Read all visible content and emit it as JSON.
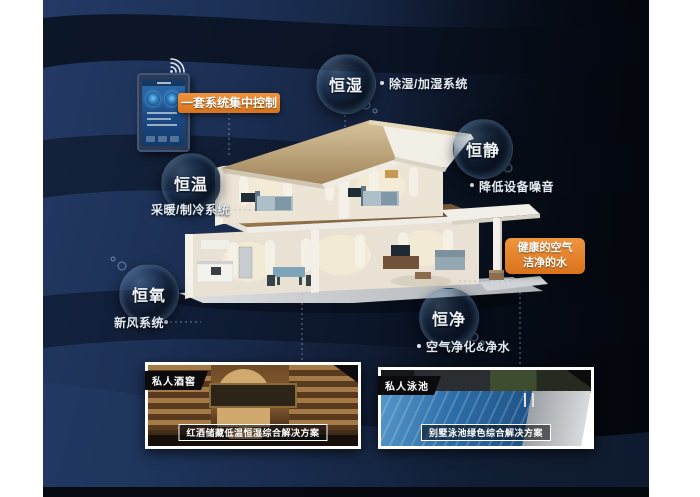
{
  "poster": {
    "accent_orange": "#e0812a",
    "background_navy": "#1e3258",
    "background_black": "#05080f",
    "bubble_text_color": "#f2f6fa"
  },
  "control_panel": {
    "callout_label": "一套系统集中控制",
    "wifi_icon": "wifi"
  },
  "healthy_callout": {
    "line1": "健康的空气",
    "line2": "洁净的水"
  },
  "features": [
    {
      "bubble_label": "恒湿",
      "note": "除湿/加湿系统"
    },
    {
      "bubble_label": "恒静",
      "note": "降低设备噪音"
    },
    {
      "bubble_label": "恒温",
      "note": "采暖/制冷系统"
    },
    {
      "bubble_label": "恒氧",
      "note": "新风系统"
    },
    {
      "bubble_label": "恒净",
      "note": "空气净化&净水"
    }
  ],
  "photos": [
    {
      "tag": "私人酒窖",
      "caption": "红酒储藏低温恒湿综合解决方案"
    },
    {
      "tag": "私人泳池",
      "caption": "别墅泳池绿色综合解决方案"
    }
  ]
}
